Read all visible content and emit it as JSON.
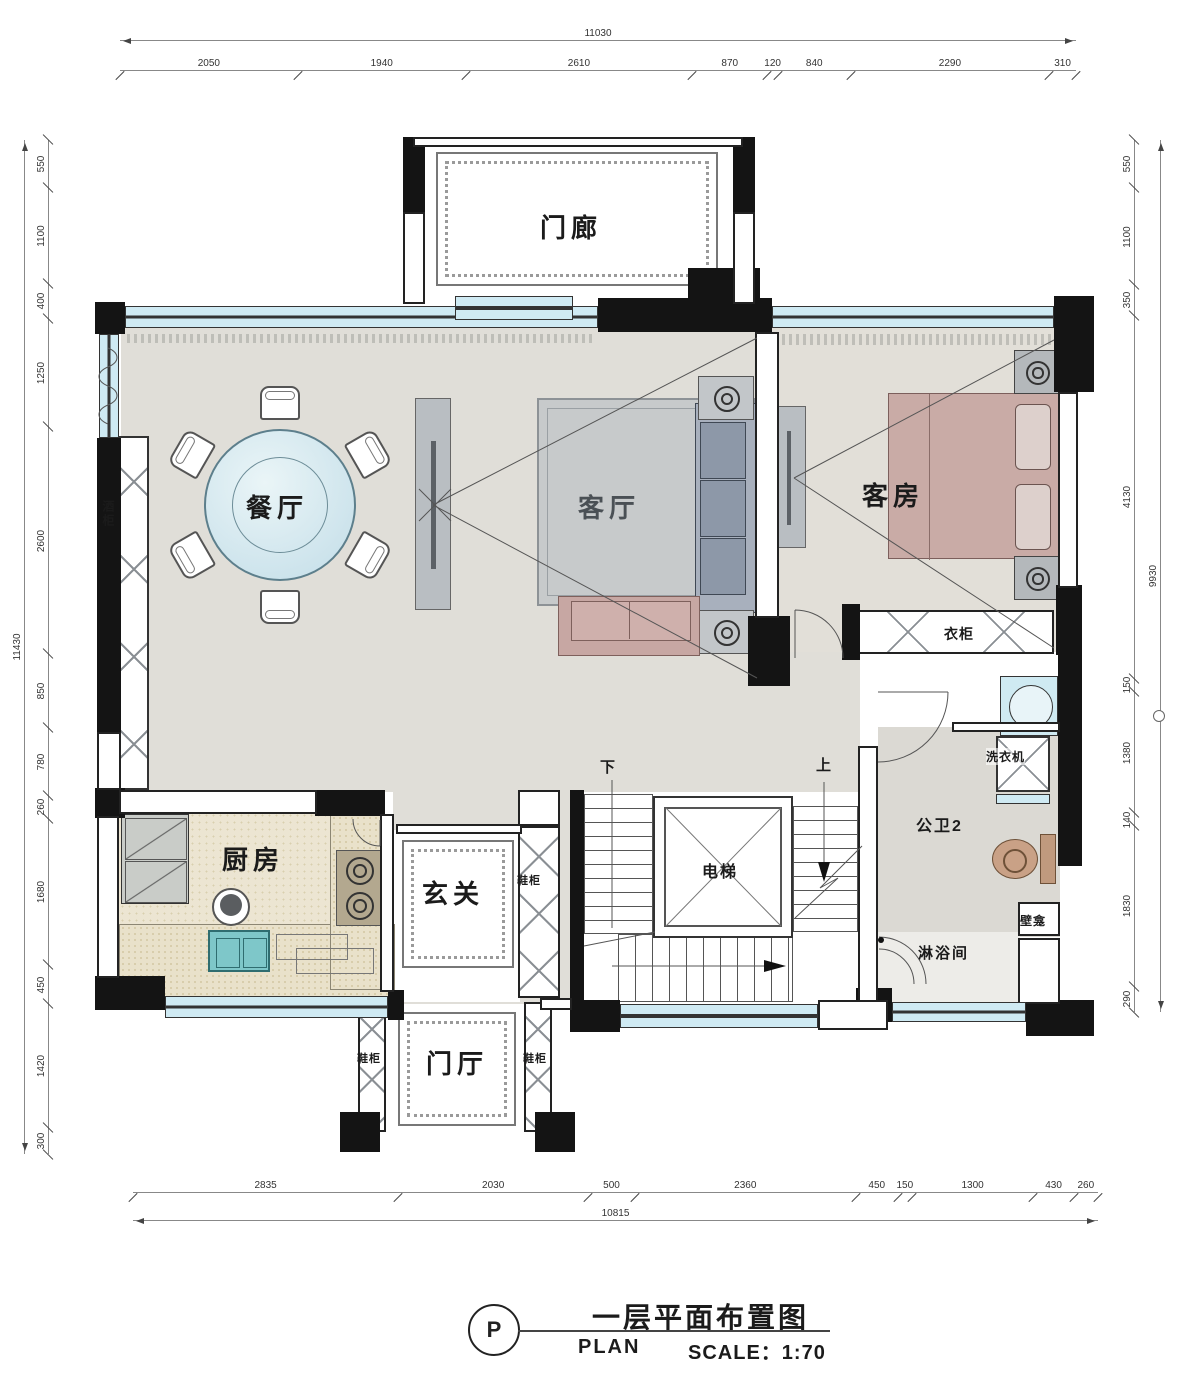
{
  "title_block": {
    "mark": "P",
    "title": "一层平面布置图",
    "plan_label": "PLAN",
    "scale_label": "SCALE：1:70"
  },
  "rooms": {
    "porch": "门廊",
    "dining": "餐厅",
    "living": "客厅",
    "guest": "客房",
    "kitchen": "厨房",
    "entry": "玄关",
    "foyer": "门厅",
    "elevator": "电梯",
    "bath": "公卫2",
    "shower": "淋浴间"
  },
  "fixtures": {
    "wine_cabinet": "酒柜",
    "wardrobe": "衣柜",
    "washer": "洗衣机",
    "niche": "壁龛",
    "shoe_cabinet_entry": "鞋柜",
    "shoe_cabinet_left": "鞋柜",
    "shoe_cabinet_right": "鞋柜"
  },
  "stairs": {
    "down": "下",
    "up": "上"
  },
  "dimensions": {
    "top": {
      "total": "11030",
      "segments": [
        "2050",
        "1940",
        "2610",
        "870",
        "120",
        "840",
        "2290",
        "310"
      ]
    },
    "bottom": {
      "total": "10815",
      "segments": [
        "2835",
        "2030",
        "500",
        "2360",
        "450",
        "150",
        "1300",
        "430",
        "260"
      ]
    },
    "left": {
      "total": "11430",
      "segments": [
        "550",
        "1100",
        "400",
        "1250",
        "2600",
        "850",
        "780",
        "260",
        "1680",
        "450",
        "1420",
        "300"
      ]
    },
    "right": {
      "total": "9930",
      "segments": [
        "550",
        "1100",
        "350",
        "4130",
        "150",
        "1380",
        "140",
        "1830",
        "290"
      ]
    }
  },
  "colors": {
    "wall": "#141414",
    "window": "#cfeaf3",
    "floor": "#e0ded8",
    "rug": "#c7cacb",
    "sofa": "#99a3b2",
    "bed": "#c9aba6",
    "table": "#c2dde8",
    "counter": "#ece5d2"
  }
}
